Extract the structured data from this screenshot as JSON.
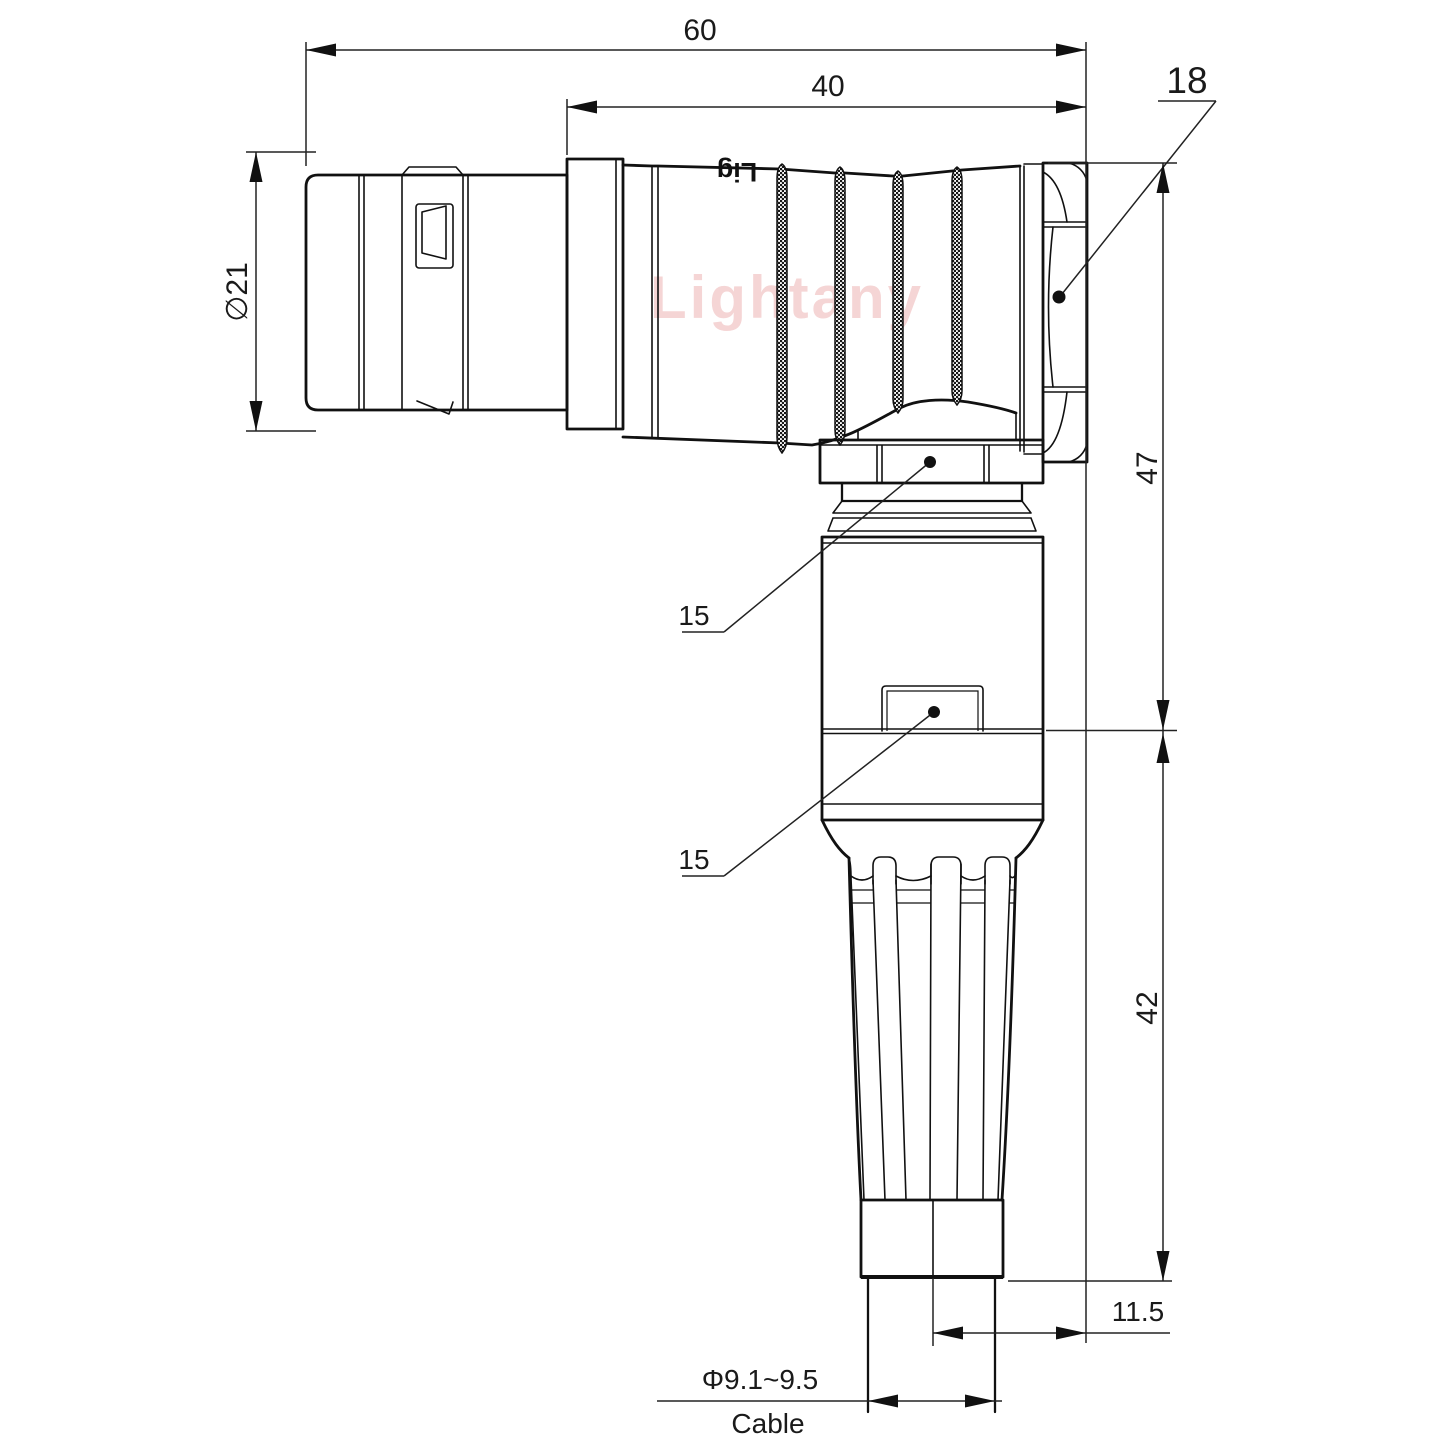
{
  "watermark": {
    "text": "Lightany",
    "color": "#e89c9c"
  },
  "part": {
    "marking": "Lig"
  },
  "dims": {
    "overall_length": "60",
    "rear_length": "40",
    "backnut_size": "18",
    "shell_diameter": "∅21",
    "elbow_height": "47",
    "nut_flat_upper": "15",
    "nut_flat_lower": "15",
    "boot_length": "42",
    "cable_offset": "11.5",
    "cable_diameter": "Φ9.1~9.5",
    "cable_label": "Cable"
  }
}
